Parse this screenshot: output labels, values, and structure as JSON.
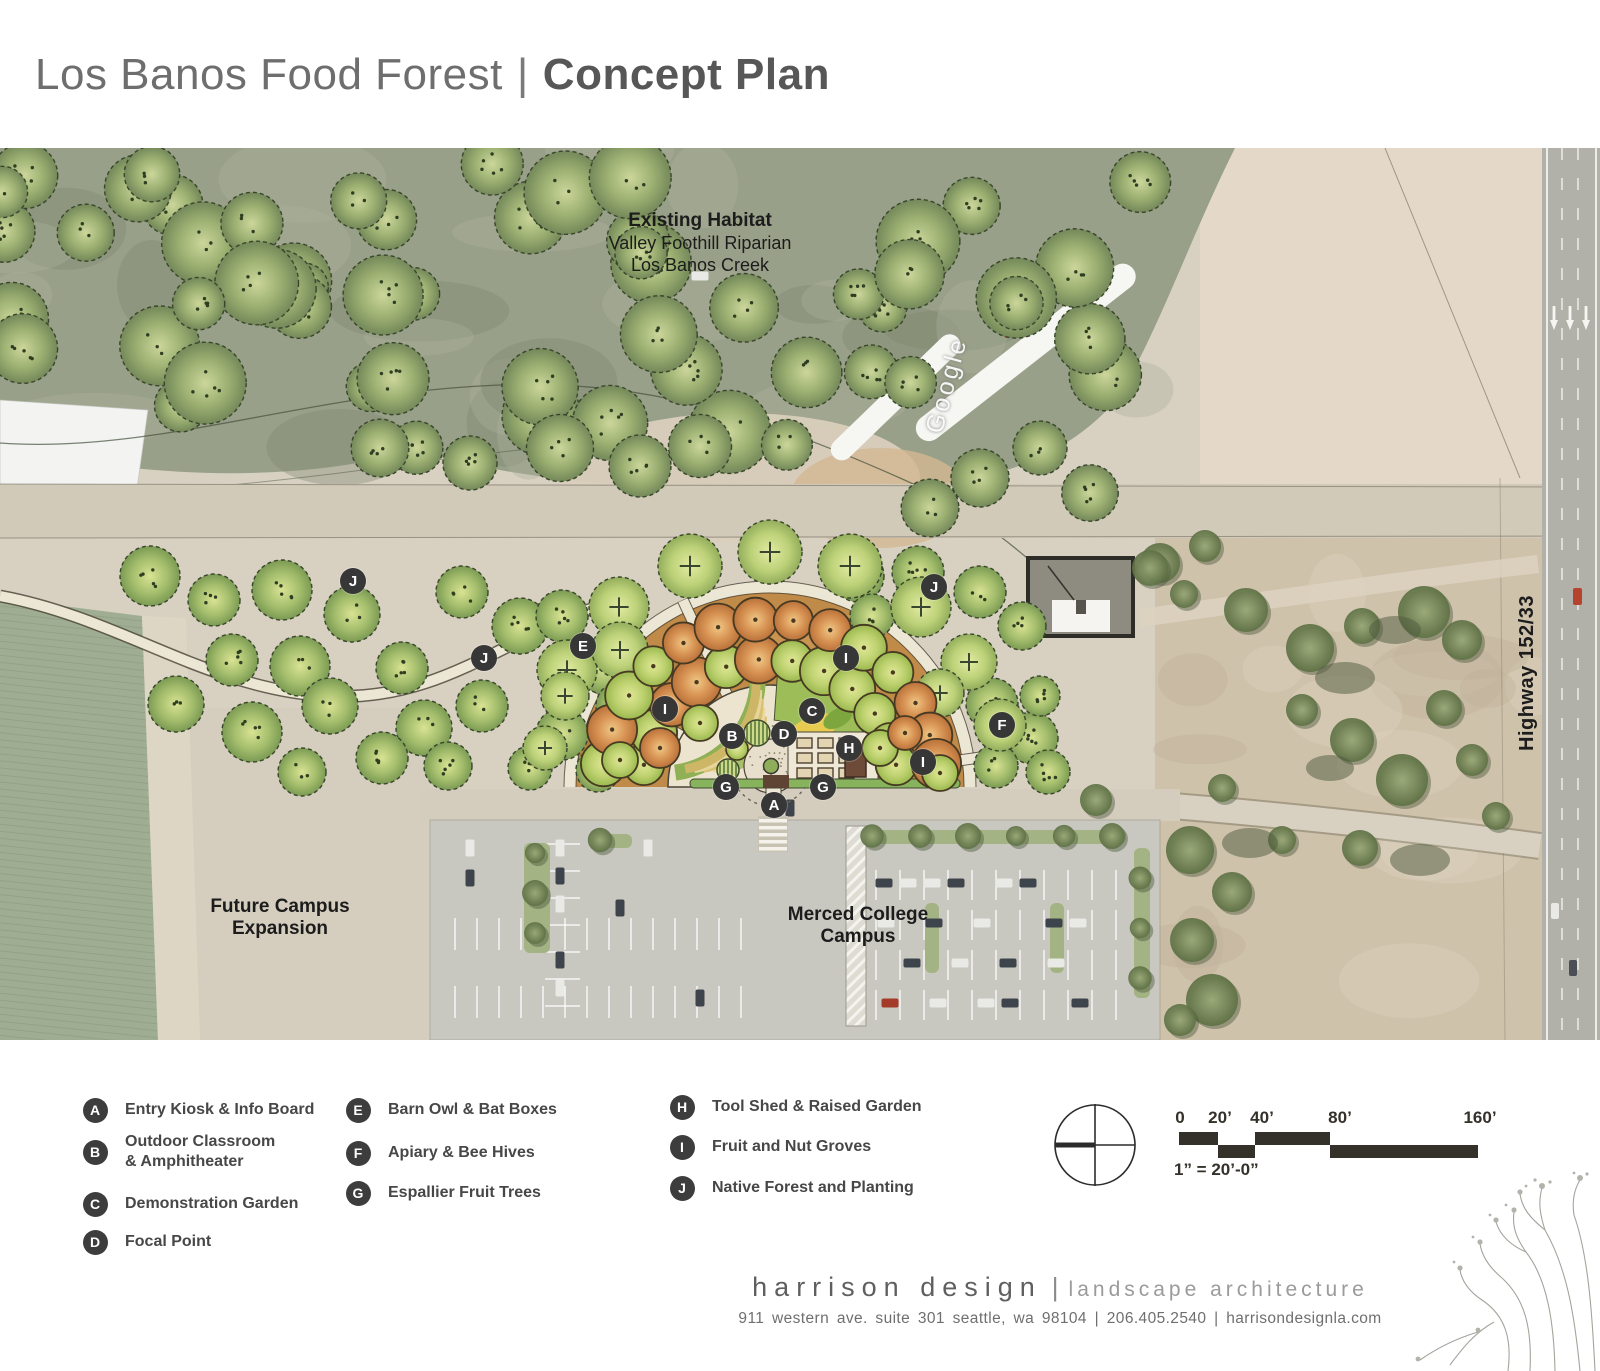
{
  "title": {
    "project": "Los Banos Food Forest",
    "separator": "|",
    "document": "Concept Plan"
  },
  "map": {
    "labels": {
      "existing_habitat": {
        "line1": "Existing Habitat",
        "line2": "Valley Foothill Riparian",
        "line3": "Los Banos Creek"
      },
      "future_campus": {
        "line1": "Future Campus",
        "line2": "Expansion"
      },
      "merced_college": {
        "line1": "Merced College",
        "line2": "Campus"
      },
      "highway": "Highway 152/33",
      "watermark": "Google"
    },
    "markers": [
      {
        "letter": "J",
        "x": 353,
        "y": 433
      },
      {
        "letter": "J",
        "x": 484,
        "y": 510
      },
      {
        "letter": "J",
        "x": 934,
        "y": 439
      },
      {
        "letter": "E",
        "x": 583,
        "y": 498
      },
      {
        "letter": "I",
        "x": 846,
        "y": 510
      },
      {
        "letter": "I",
        "x": 665,
        "y": 561
      },
      {
        "letter": "C",
        "x": 812,
        "y": 563
      },
      {
        "letter": "B",
        "x": 732,
        "y": 588
      },
      {
        "letter": "D",
        "x": 784,
        "y": 586
      },
      {
        "letter": "H",
        "x": 849,
        "y": 600
      },
      {
        "letter": "F",
        "x": 1002,
        "y": 577
      },
      {
        "letter": "I",
        "x": 923,
        "y": 614
      },
      {
        "letter": "G",
        "x": 726,
        "y": 639
      },
      {
        "letter": "G",
        "x": 823,
        "y": 639
      },
      {
        "letter": "A",
        "x": 774,
        "y": 657
      }
    ]
  },
  "legend": {
    "columns": [
      {
        "items": [
          {
            "letter": "A",
            "lines": [
              "Entry Kiosk & Info Board"
            ]
          },
          {
            "letter": "B",
            "lines": [
              "Outdoor Classroom",
              "& Amphitheater"
            ]
          },
          {
            "letter": "C",
            "lines": [
              "Demonstration Garden"
            ]
          },
          {
            "letter": "D",
            "lines": [
              "Focal Point"
            ]
          }
        ]
      },
      {
        "items": [
          {
            "letter": "E",
            "lines": [
              "Barn Owl & Bat Boxes"
            ]
          },
          {
            "letter": "F",
            "lines": [
              "Apiary & Bee Hives"
            ]
          },
          {
            "letter": "G",
            "lines": [
              "Espallier Fruit Trees"
            ]
          }
        ]
      },
      {
        "items": [
          {
            "letter": "H",
            "lines": [
              "Tool Shed & Raised Garden"
            ]
          },
          {
            "letter": "I",
            "lines": [
              "Fruit and Nut Groves"
            ]
          },
          {
            "letter": "J",
            "lines": [
              "Native Forest and Planting"
            ]
          }
        ]
      }
    ]
  },
  "scale": {
    "ticks": [
      "0",
      "20’",
      "40’",
      "80’",
      "160’"
    ],
    "note": "1” = 20’-0”"
  },
  "footer": {
    "firm": "harrison design",
    "separator": "|",
    "tagline": "landscape architecture",
    "address": "911 western ave. suite 301 seattle, wa 98104 | 206.405.2540 | harrisondesignla.com"
  },
  "colors": {
    "marker_bg": "#373737",
    "orchard": "#c08a48",
    "fruit_green": "#bcd06e",
    "fruit_orange": "#d89454",
    "native_green": "#a3bd6c",
    "path_cream": "#ece6d4",
    "habitat": "#99a089",
    "field_green": "#9fae92",
    "parking_gray": "#c9c8c0",
    "highway_gray": "#b2b1a9"
  }
}
